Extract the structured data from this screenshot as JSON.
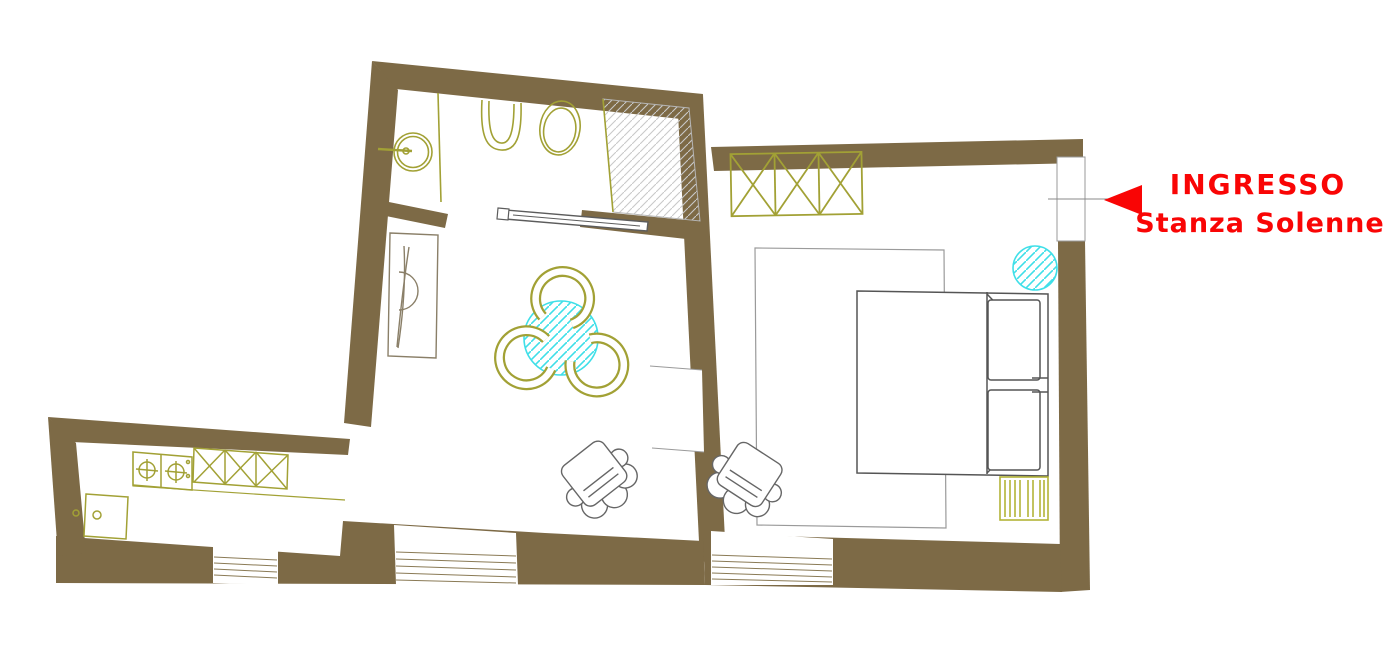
{
  "meta": {
    "type": "floor-plan",
    "description": "apartment floor plan with entrance annotation"
  },
  "entrance": {
    "label_line1": "INGRESSO",
    "label_line2": "Stanza Solenne",
    "arrow_direction": "left"
  },
  "colors": {
    "wall": "#7d6a46",
    "fixtures_olive": "#a2a135",
    "radiator_olive": "#b2b437",
    "accent_red": "#f90505",
    "water_cyan": "#3fdfe8",
    "furniture_gray": "#5c5c5c",
    "rug_gray": "#9a9a9a",
    "hatch_gray": "#c9c9c9"
  },
  "rooms": {
    "bathroom": {
      "name": "bathroom",
      "features": [
        "washbasin",
        "bidet",
        "toilet",
        "shower",
        "sliding-door"
      ]
    },
    "living_room": {
      "name": "living room",
      "features": [
        "console-table",
        "round-table",
        "three-chairs",
        "armchair",
        "window"
      ]
    },
    "bedroom": {
      "name": "bedroom",
      "features": [
        "wardrobe",
        "double-bed",
        "rug",
        "radiator",
        "armchair",
        "side-table",
        "window",
        "entrance-door"
      ]
    },
    "kitchen": {
      "name": "kitchen",
      "features": [
        "hob",
        "cabinets",
        "sink-unit",
        "counter",
        "window"
      ]
    }
  }
}
